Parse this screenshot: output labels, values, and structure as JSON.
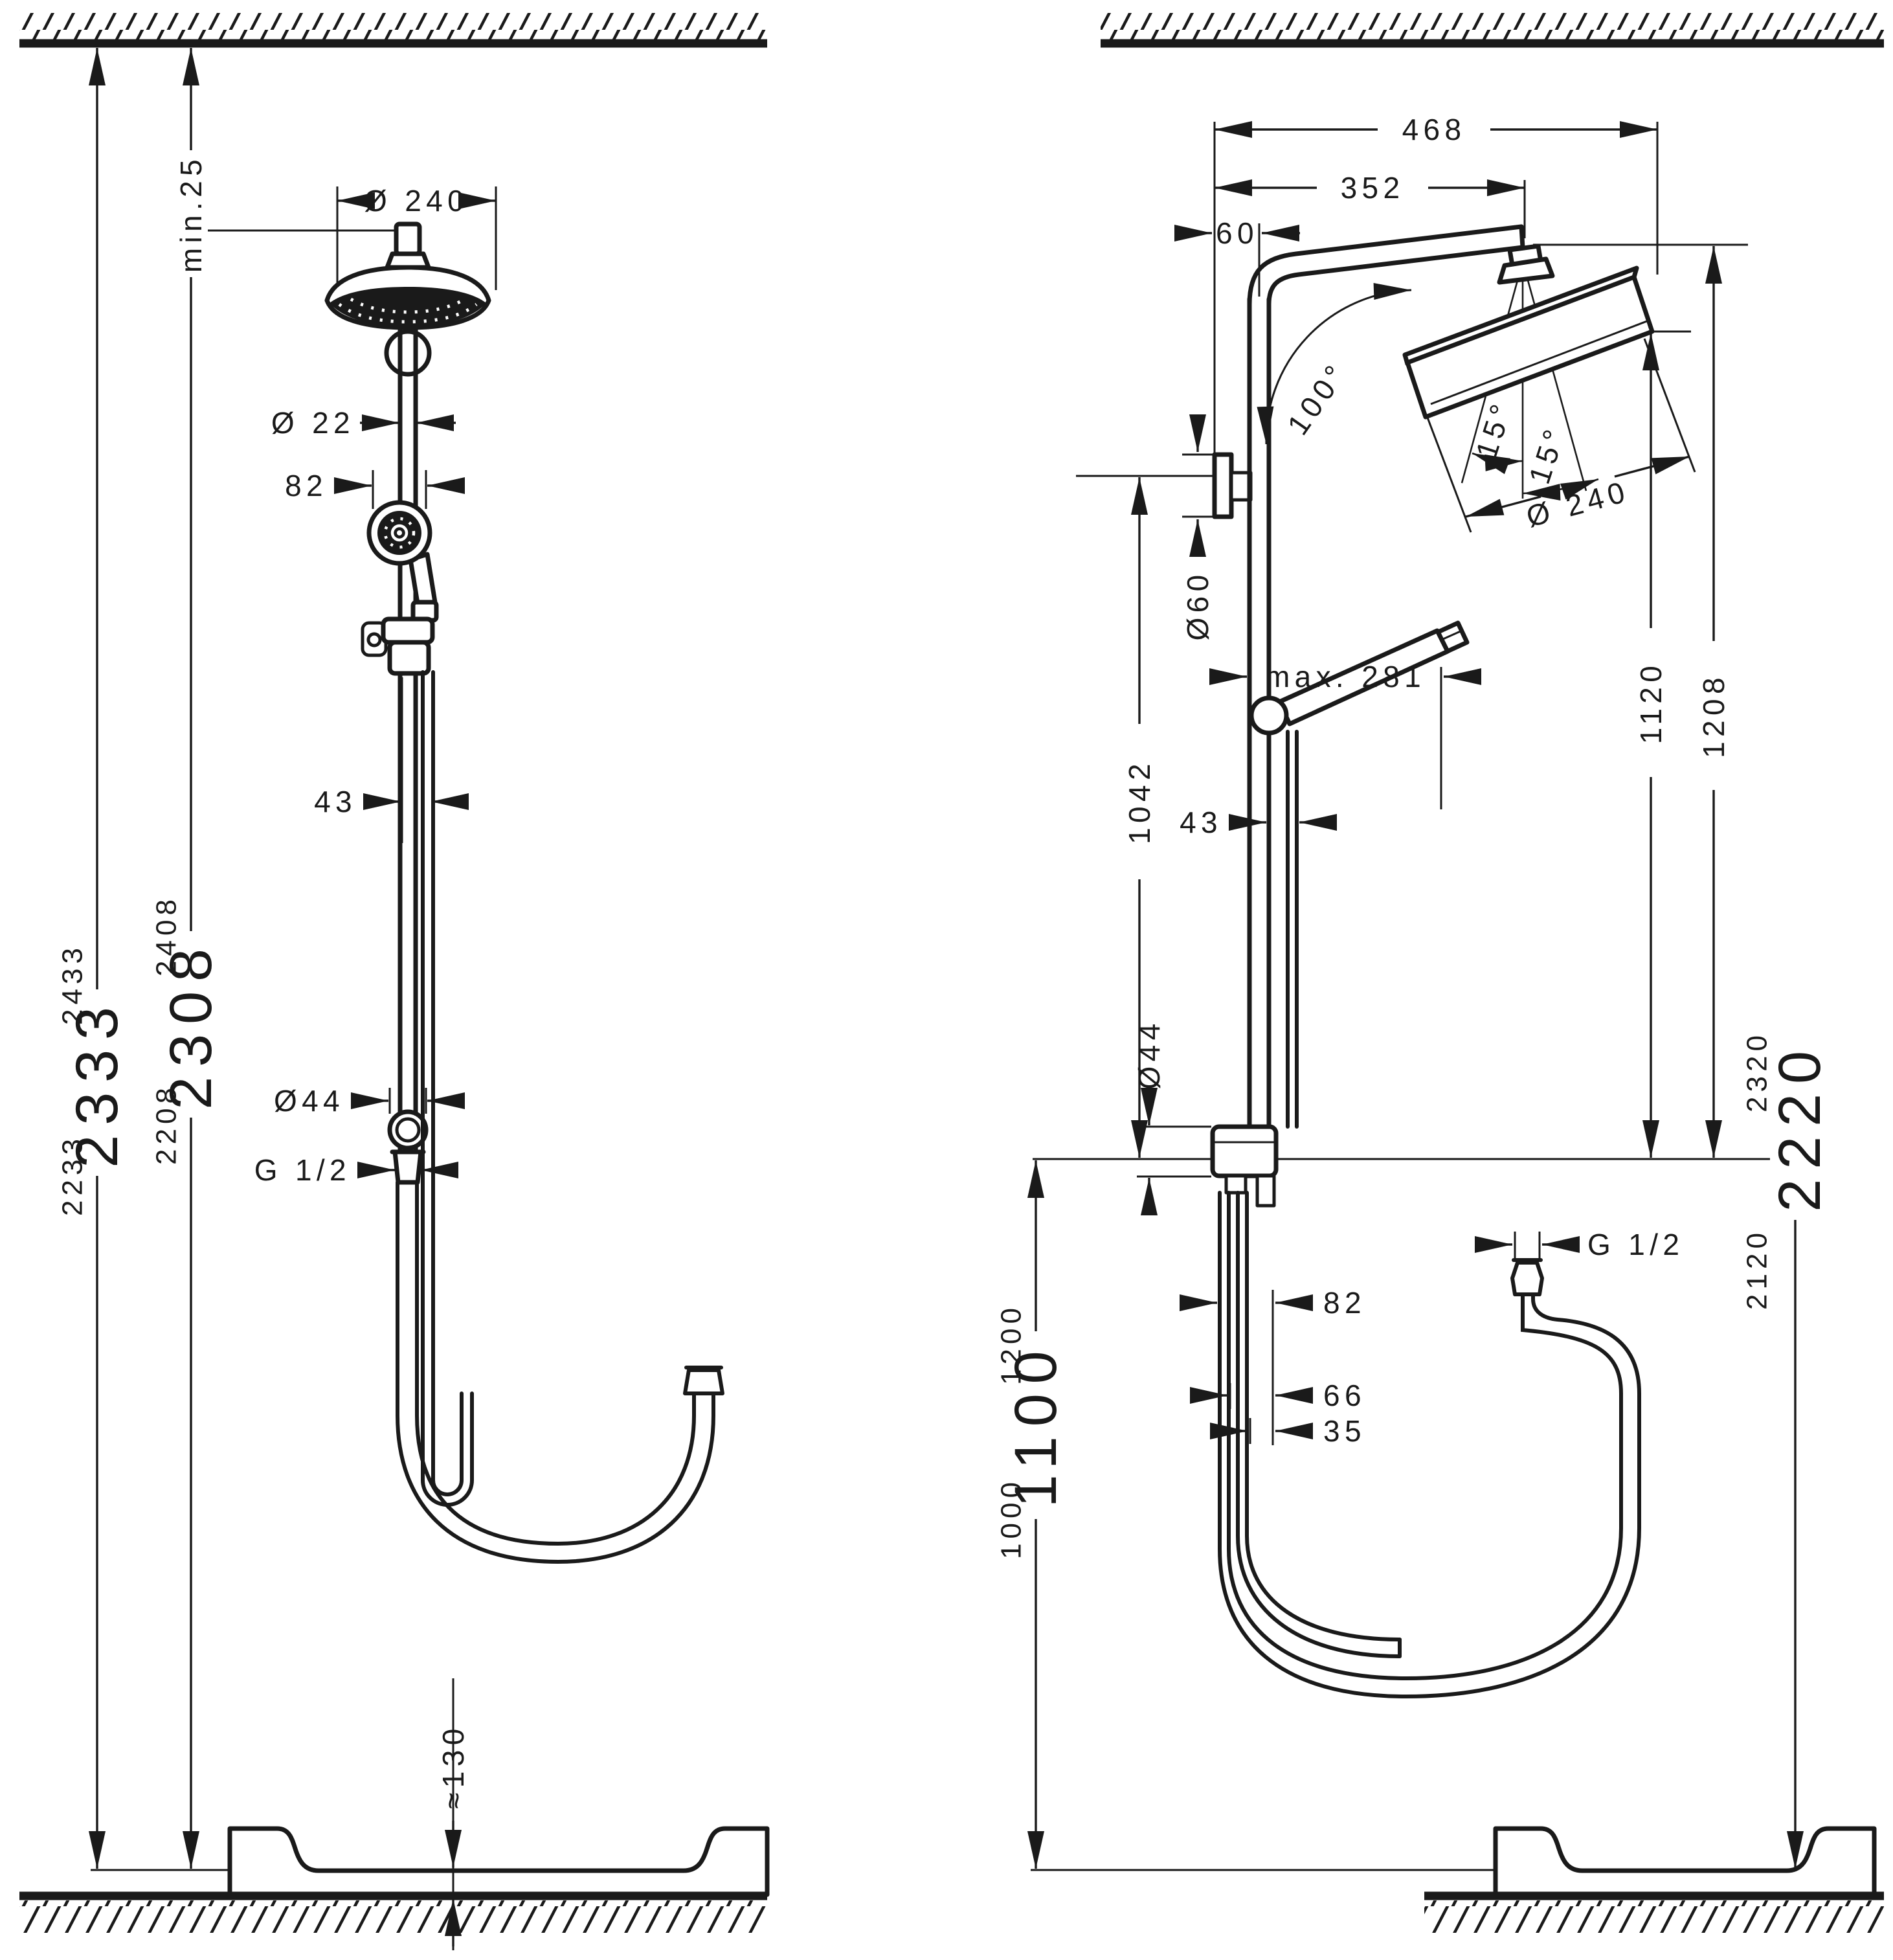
{
  "colors": {
    "ink": "#1a1a1a",
    "paper": "#ffffff"
  },
  "left": {
    "min25": "min.25",
    "dia240": "Ø 240",
    "dia22": "Ø 22",
    "d82": "82",
    "d43": "43",
    "dia44": "Ø44",
    "g12": "G 1/2",
    "h130": "≈130",
    "hA": {
      "low": "2233",
      "big": "2333",
      "high": "2433"
    },
    "hB": {
      "low": "2208",
      "big": "2308",
      "high": "2408"
    }
  },
  "right": {
    "d468": "468",
    "d352": "352",
    "d60": "60",
    "a100": "100°",
    "a15l": "15°",
    "a15r": "15°",
    "dia240": "Ø 240",
    "dia60": "Ø60",
    "max281": "max. 281",
    "d43": "43",
    "d1042": "1042",
    "d1120": "1120",
    "d1208": "1208",
    "dia44": "Ø44",
    "d82": "82",
    "d66": "66",
    "d35": "35",
    "g12": "G 1/2",
    "hC": {
      "low": "1000",
      "big": "1100",
      "high": "1200"
    },
    "hD": {
      "low": "2120",
      "big": "2220",
      "high": "2320"
    }
  }
}
